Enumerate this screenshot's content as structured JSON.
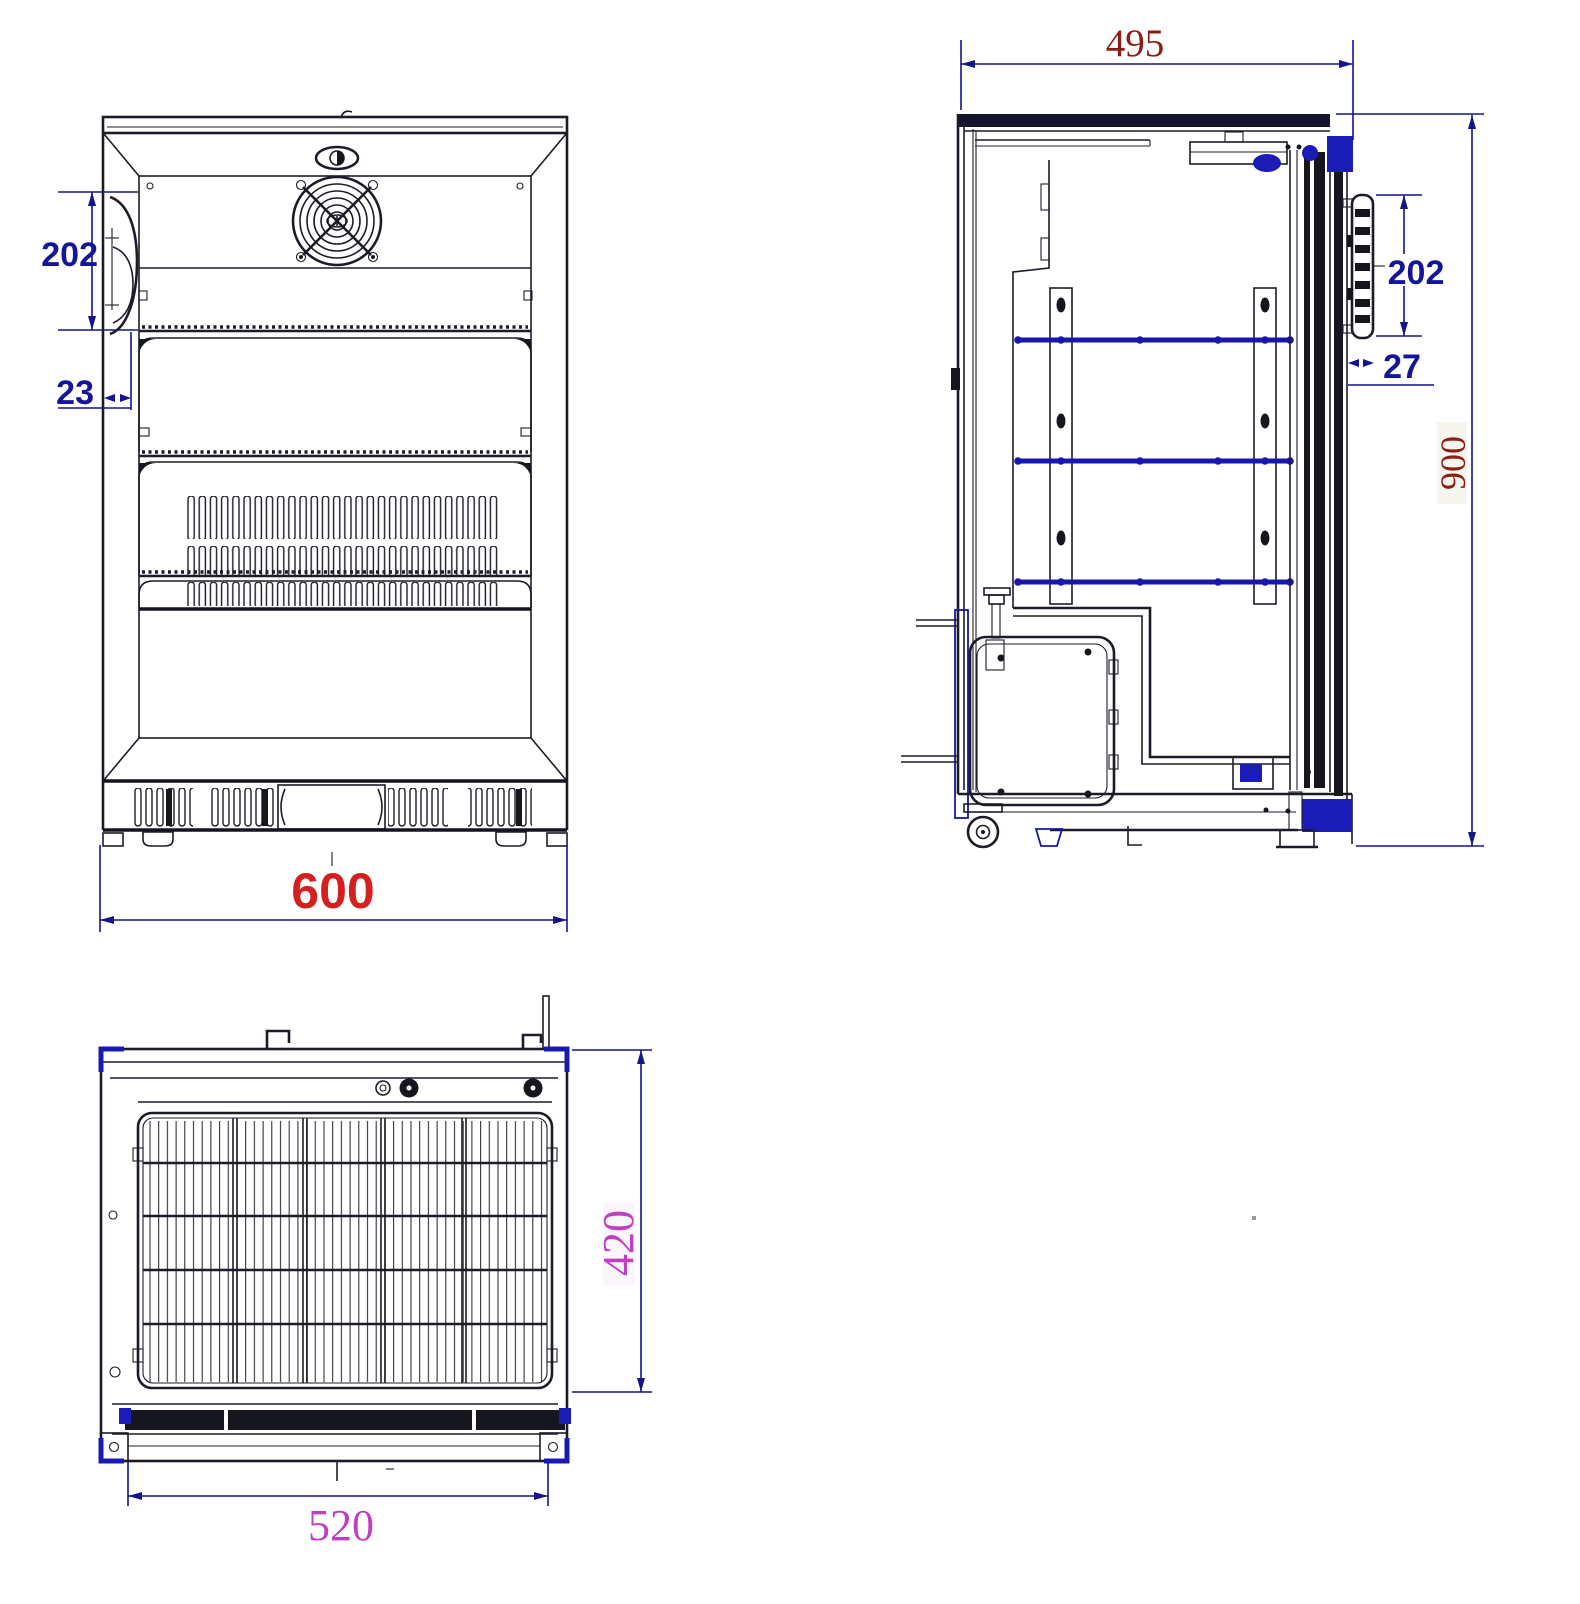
{
  "drawing": {
    "front_view": {
      "handle_height_label": "202",
      "handle_offset_label": "23",
      "width_label": "600"
    },
    "side_view": {
      "depth_label": "495",
      "handle_height_label": "202",
      "handle_depth_label": "27",
      "height_label": "900"
    },
    "top_view": {
      "grille_depth_label": "420",
      "grille_width_label": "520"
    }
  },
  "colors": {
    "dimension_blue": "#15159a",
    "bright_red": "#d62020",
    "dark_red": "#8c1d15",
    "magenta": "#c03fc0",
    "line_black": "#1c1c28",
    "accent_navy": "#1b1bb8"
  }
}
